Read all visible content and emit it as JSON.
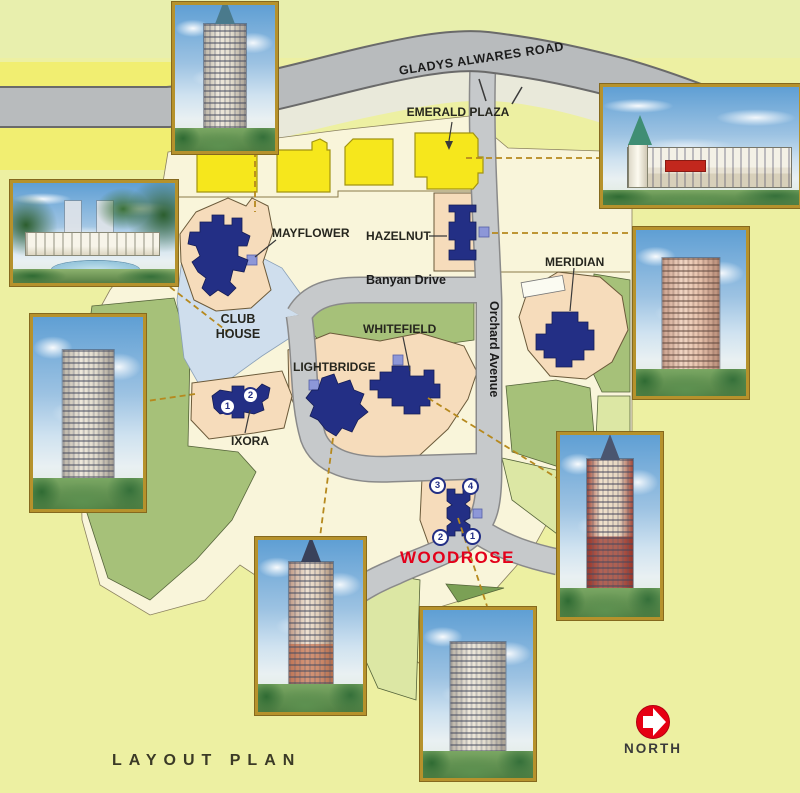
{
  "title": "LAYOUT PLAN",
  "compass": {
    "label": "NORTH"
  },
  "roads": {
    "gladys_alwares": "GLADYS ALWARES ROAD",
    "banyan_drive": "Banyan Drive",
    "orchard_avenue": "Orchard Avenue"
  },
  "places": {
    "emerald_plaza": "EMERALD PLAZA",
    "mayflower": "MAYFLOWER",
    "hazelnut": "HAZELNUT",
    "meridian": "MERIDIAN",
    "club_house_line1": "CLUB",
    "club_house_line2": "HOUSE",
    "whitefield": "WHITEFIELD",
    "lightbridge": "LIGHTBRIDGE",
    "ixora": "IXORA",
    "woodrose": "WOODROSE"
  },
  "unit_markers": {
    "ixora": [
      "1",
      "2"
    ],
    "woodrose": [
      "3",
      "4",
      "2",
      "1"
    ]
  },
  "photos": [
    {
      "name": "highrise-tower-rendering-top-left"
    },
    {
      "name": "retail-plaza-rendering-top-right"
    },
    {
      "name": "clubhouse-pool-rendering-left"
    },
    {
      "name": "highrise-tower-rendering-mid-left"
    },
    {
      "name": "spire-tower-rendering-bottom-left"
    },
    {
      "name": "highrise-tower-rendering-bottom-center"
    },
    {
      "name": "highrise-tower-rendering-right"
    },
    {
      "name": "spire-tower-rendering-bottom-right"
    }
  ],
  "colors": {
    "background": "#edf0a2",
    "map_area": "#f9f5da",
    "main_road": "#b8bbbd",
    "inner_road": "#c6c9cb",
    "plot": "#f6dcbb",
    "building": "#232f85",
    "annex_block": "#8d97d8",
    "emerald_buildings": "#f6e71c",
    "green_area": "#a6c179",
    "light_green": "#dce7a4",
    "club_house_area": "#cfdeed",
    "woodrose_text": "#e3001a",
    "north_arrow": "#e60013",
    "dashed_connector": "#b6891e",
    "photo_border": "#b6922c"
  }
}
